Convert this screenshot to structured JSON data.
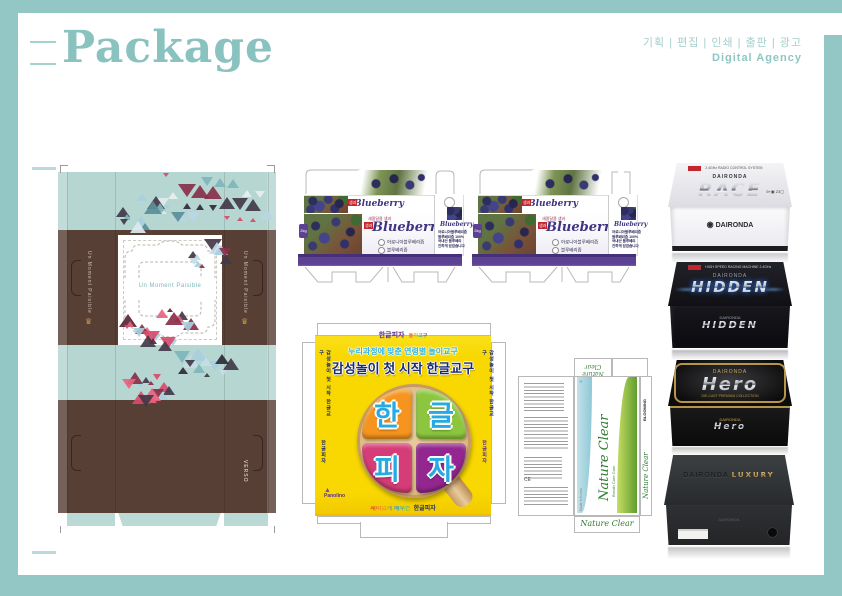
{
  "colors": {
    "frame": "#92c7c5",
    "title": "#8ac2c0",
    "blueberry_purple": "#5d4192",
    "pizza_yellow": "#f8d800",
    "nature_green": "#5f9e2f",
    "gold": "#b8934a"
  },
  "header": {
    "title": "Package",
    "services": "기획 | 편집 | 인쇄 | 출판 | 광고",
    "agency": "Digital Agency"
  },
  "sofa": {
    "tagline": "Un Moment Paisible",
    "side_text": "Un Moment Paisible",
    "brand": "VERSO",
    "crown": "♛"
  },
  "blueberry": {
    "pre_title": "새콤달콤 생과",
    "title": "Blueberry",
    "tag": "생과",
    "option1": "아로니아블루베리즙",
    "option2": "블루베리즙",
    "weight": "2kg",
    "side_title": "Blueberry",
    "side_line1": "아로니아블루베리즙",
    "side_line2": "블루베리즙 100%",
    "side_line3": "국내산 블루베리",
    "side_line4": "진하게 담았습니다"
  },
  "pizza": {
    "top_brand": "한글피자",
    "top_sub": "놀이교구",
    "headline1": "누리과정에 맞춘 연령별 놀이교구",
    "headline2": "감성놀이 첫 시작 한글교구",
    "slices": [
      {
        "char": "한"
      },
      {
        "char": "글"
      },
      {
        "char": "피"
      },
      {
        "char": "자"
      }
    ],
    "side_text": "한글피자",
    "side_text2": "감성놀이 첫 시작 한글교구",
    "logo_icon": "▲",
    "logo_text": "Panolino",
    "bottom_prefix": "재미있게 배우는",
    "bottom_name": "한글피자"
  },
  "nature": {
    "name": "Nature Clear",
    "subtitle": "Breath Care Gum",
    "brand": "BLOOMING",
    "brand_icon": "▲",
    "side_label": "Made in Korea",
    "ce": "CE",
    "recycle": "♻"
  },
  "boxes": [
    {
      "brand": "DAIRONDA",
      "name": "RACE",
      "note": "2.4GHz RADIO CONTROL SYSTEM",
      "tag_label": "",
      "mark1": "5+",
      "mark2": "23",
      "front_brand": "DAIRONDA",
      "emblem": "◉"
    },
    {
      "brand": "DAIRONDA",
      "name": "HIDDEN",
      "note": "HIGH SPEED RACING MACHINE 2.4GHz",
      "front_brand": "DAIRONDA",
      "front_name": "HIDDEN"
    },
    {
      "brand": "DAIRONDA",
      "name": "Hero",
      "note": "DIE-CAST PREMIUM COLLECTION",
      "front_name": "Hero"
    },
    {
      "brand": "DAIRONDA",
      "name": "LUXURY",
      "front_note": "DAIRONDA"
    }
  ]
}
